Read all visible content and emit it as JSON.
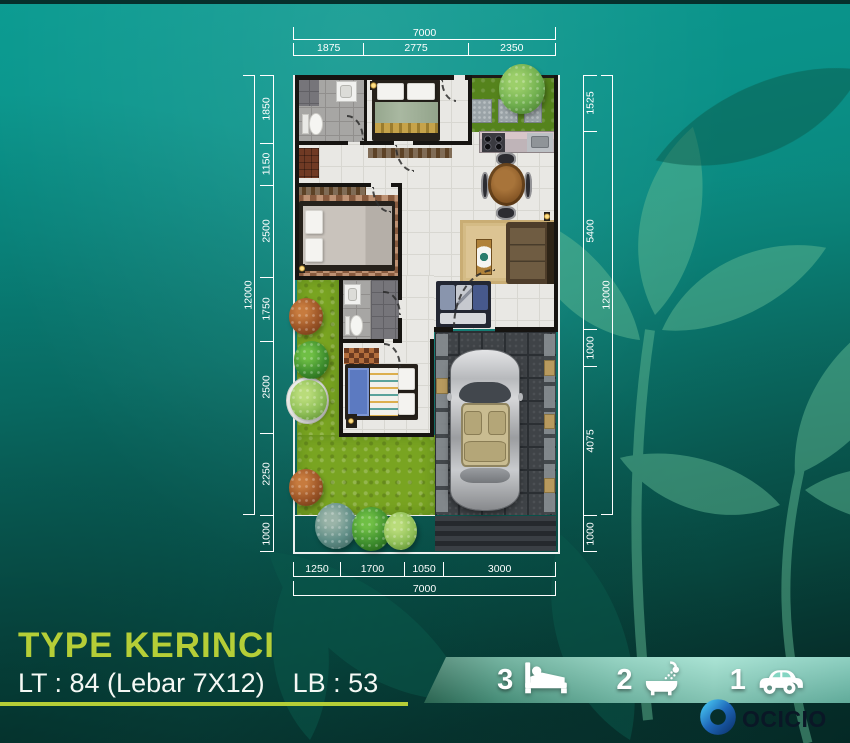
{
  "title": {
    "name": "TYPE KERINCI",
    "lt": "LT : 84 (Lebar 7X12)",
    "lb": "LB : 53"
  },
  "plan": {
    "dimensions": {
      "top": {
        "overall": "7000",
        "segments": [
          "1875",
          "2775",
          "2350"
        ]
      },
      "bottom": {
        "overall": "7000",
        "segments": [
          "1250",
          "1700",
          "1050",
          "3000"
        ]
      },
      "left": {
        "overall": "12000",
        "segments": [
          "1850",
          "1150",
          "2500",
          "1750",
          "2500",
          "2250",
          "1000"
        ]
      },
      "right": {
        "overall": "12000",
        "segments": [
          "1525",
          "5400",
          "1000",
          "4075",
          "1000"
        ]
      }
    }
  },
  "features": [
    {
      "label": "bedrooms",
      "count": "3",
      "icon": "bed-icon"
    },
    {
      "label": "bathrooms",
      "count": "2",
      "icon": "bath-icon"
    },
    {
      "label": "carport",
      "count": "1",
      "icon": "car-icon"
    }
  ],
  "logo": {
    "text": "OCICIO"
  },
  "colors": {
    "accent": "#b5ce37",
    "background_teal": "#0a8f85",
    "band_teal": "#7fcdbb",
    "leaf_green": "#5fb892",
    "logo_blue": "#1e66b8"
  }
}
